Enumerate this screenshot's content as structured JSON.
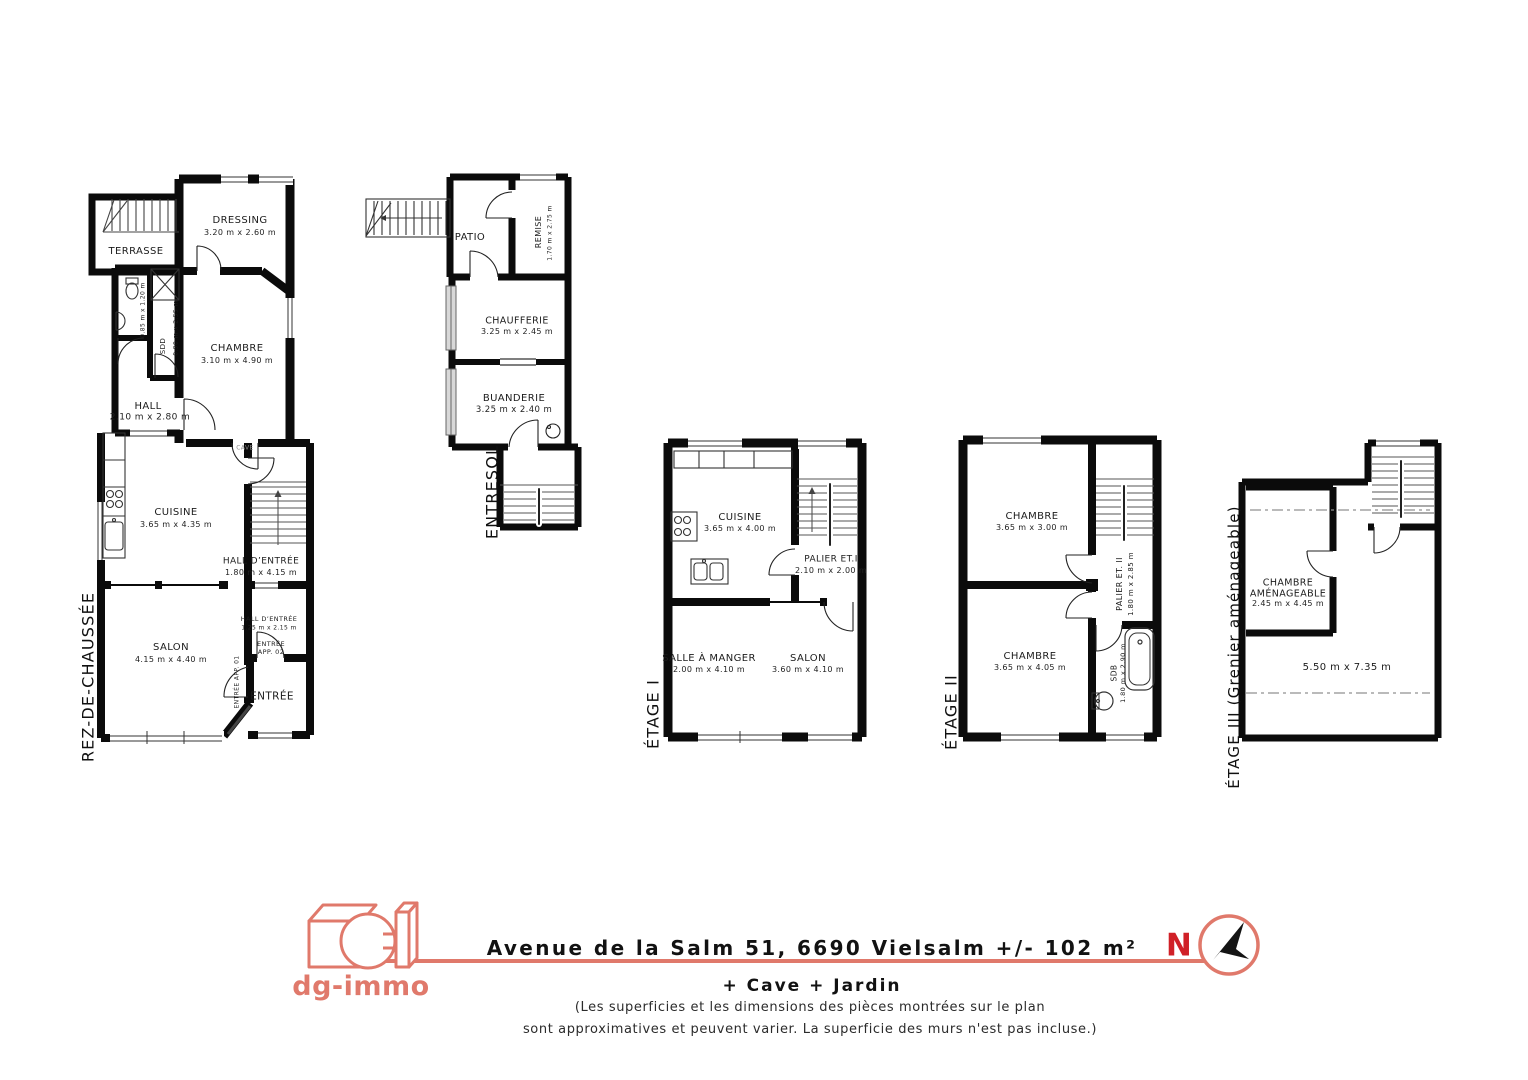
{
  "brand": {
    "name": "dg-immo",
    "north": "N"
  },
  "colors": {
    "accent": "#E0796B",
    "north_red": "#D02027",
    "wall": "#0b0b0b"
  },
  "footer": {
    "address": "Avenue de la Salm 51, 6690 Vielsalm +/- 102 m²",
    "extras": "+ Cave + Jardin",
    "disclaimer_line1": "(Les superficies et les dimensions des pièces montrées sur le plan",
    "disclaimer_line2": "sont approximatives et peuvent varier. La superficie des murs n'est pas incluse.)"
  },
  "floors": {
    "rdc": {
      "label": "REZ-DE-CHAUSSÉE",
      "rooms": {
        "terrasse": {
          "name": "TERRASSE"
        },
        "dressing": {
          "name": "DRESSING",
          "dims": "3.20 m x 2.60 m"
        },
        "chambre": {
          "name": "CHAMBRE",
          "dims": "3.10 m x 4.90 m"
        },
        "wc": {
          "dims": "0.85 m x 1.20 m"
        },
        "sdd": {
          "name": "SDD",
          "dims": "0.90 m x 2.55 m"
        },
        "hall": {
          "name": "HALL",
          "dims": "2.10 m x 2.80 m"
        },
        "cuisine": {
          "name": "CUISINE",
          "dims": "3.65 m x 4.35 m"
        },
        "hall_entree": {
          "name": "HALL D’ENTRÉE",
          "dims": "1.80 m x 4.15 m"
        },
        "salon": {
          "name": "SALON",
          "dims": "4.15 m x 4.40 m"
        },
        "hall_entree_2": {
          "name": "HALL D’ENTRÉE",
          "dims": "1.25 m x 2.15 m"
        },
        "entree_app_02": {
          "name": "ENTRÉE APP. 02"
        },
        "entree_app_01": {
          "name": "ENTRÉE APP. 01"
        },
        "entree": {
          "name": "ENTRÉE"
        },
        "cave": {
          "name": "CAVE"
        }
      }
    },
    "entresol": {
      "label": "ENTRESOL",
      "rooms": {
        "patio": {
          "name": "PATIO"
        },
        "remise": {
          "name": "REMISE",
          "dims": "1.70 m x 2.75 m"
        },
        "chaufferie": {
          "name": "CHAUFFERIE",
          "dims": "3.25 m x 2.45 m"
        },
        "buanderie": {
          "name": "BUANDERIE",
          "dims": "3.25 m x 2.40 m"
        }
      }
    },
    "etage1": {
      "label": "ÉTAGE I",
      "rooms": {
        "cuisine": {
          "name": "CUISINE",
          "dims": "3.65 m x 4.00 m"
        },
        "palier": {
          "name": "PALIER ET.I",
          "dims": "2.10 m x 2.00 m"
        },
        "salle_a_manger": {
          "name": "SALLE À MANGER",
          "dims": "2.00 m x 4.10 m"
        },
        "salon": {
          "name": "SALON",
          "dims": "3.60 m x 4.10 m"
        }
      }
    },
    "etage2": {
      "label": "ÉTAGE II",
      "rooms": {
        "chambre_1": {
          "name": "CHAMBRE",
          "dims": "3.65 m x 3.00 m"
        },
        "palier": {
          "name": "PALIER ET. II",
          "dims": "1.80 m x 2.85 m"
        },
        "chambre_2": {
          "name": "CHAMBRE",
          "dims": "3.65 m x 4.05 m"
        },
        "sdb": {
          "name": "SDB",
          "dims": "1.80 m x 2.90 m"
        }
      }
    },
    "etage3": {
      "label": "ÉTAGE III (Grenier aménageable)",
      "rooms": {
        "chambre_amenageable": {
          "name": "CHAMBRE AMÉNAGEABLE",
          "dims": "2.45 m x 4.45 m"
        },
        "grenier": {
          "dims": "5.50 m x 7.35 m"
        }
      }
    }
  }
}
